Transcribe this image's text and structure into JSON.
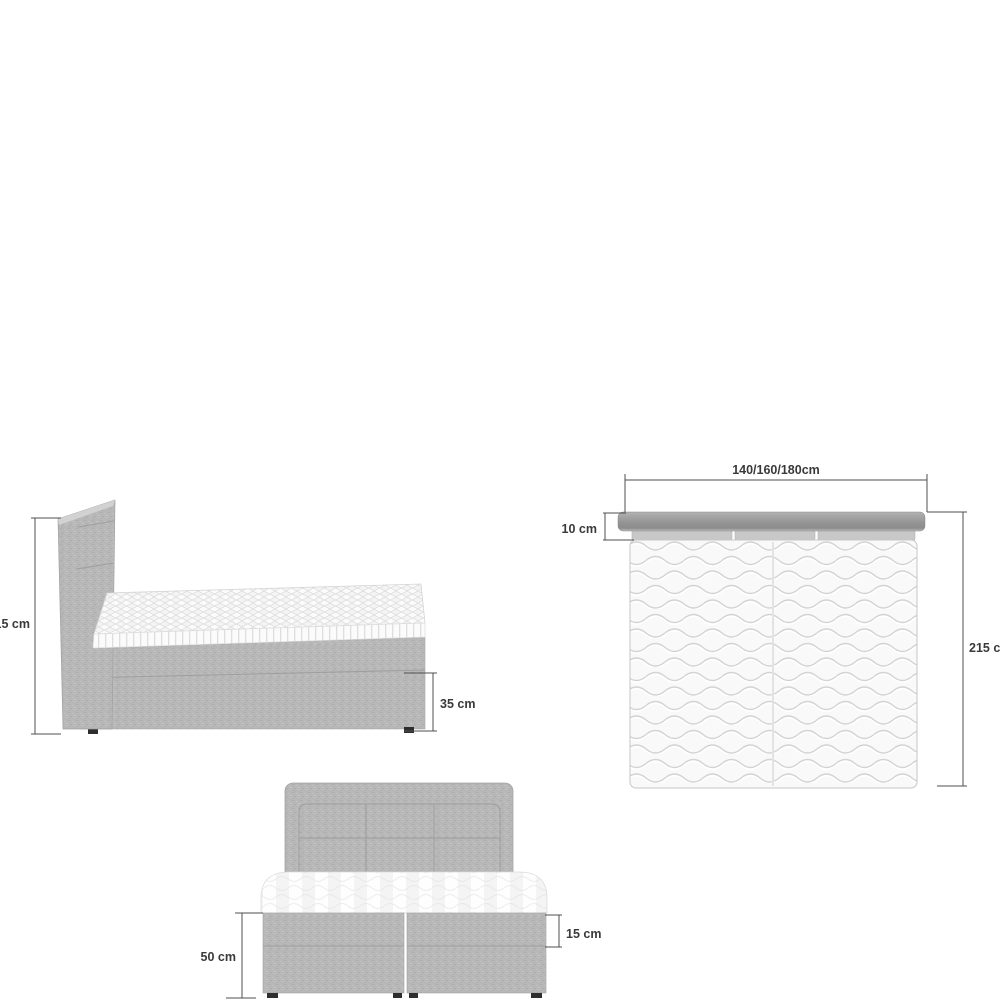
{
  "diagram": {
    "title": "bed-dimension-diagram",
    "views": {
      "side": {
        "label": "side-view",
        "dimensions": {
          "total_height": "115 cm",
          "lower_base_height": "35 cm"
        }
      },
      "top": {
        "label": "top-view",
        "dimensions": {
          "width_options": "140/160/180cm",
          "headboard_depth": "10 cm",
          "length": "215 cm"
        }
      },
      "front": {
        "label": "front-view",
        "dimensions": {
          "base_total_height": "50 cm",
          "upper_base_height": "15 cm"
        }
      }
    },
    "colors": {
      "background": "#ffffff",
      "fabric_gray": "#b7b7b7",
      "headboard_strip_gray": "#949494",
      "mattress_white": "#f9f9f9",
      "wave_line": "#d3d3d3",
      "dimension_line": "#4f4f4f",
      "label_text": "#3a3a3a",
      "feet_dark": "#2e2e2e"
    }
  }
}
